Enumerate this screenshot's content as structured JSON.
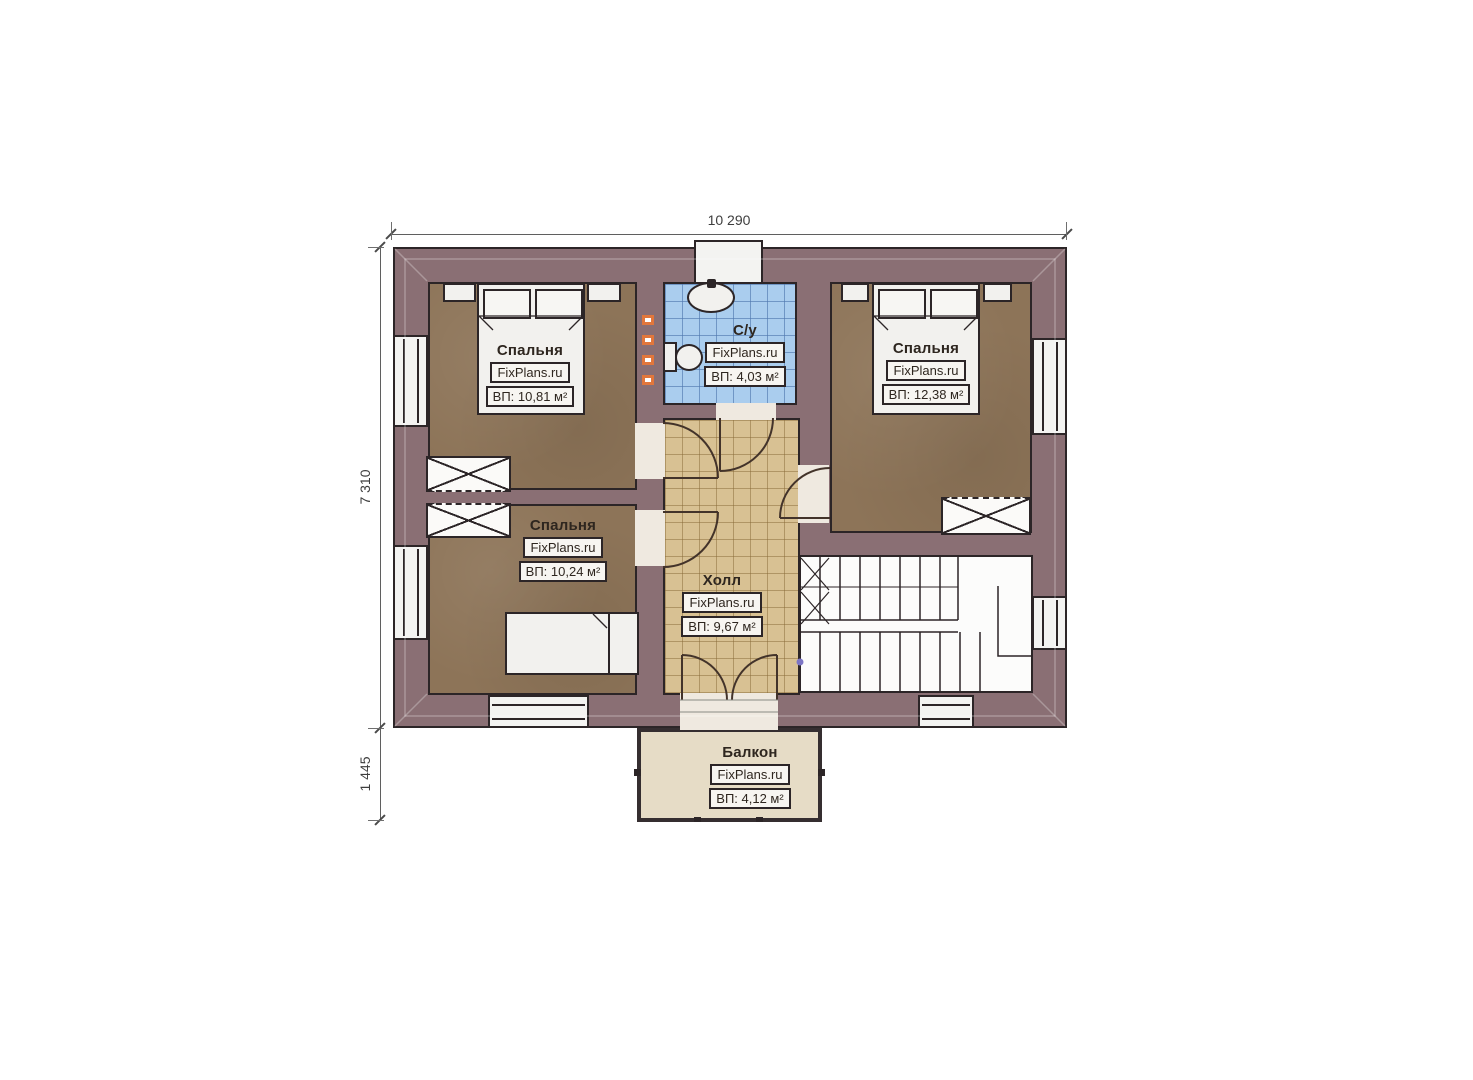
{
  "dimensions": {
    "width": "10 290",
    "height": "7 310",
    "balcony_depth": "1 445"
  },
  "watermark": "FixPlans.ru",
  "rooms": {
    "bedroom_top_left": {
      "name": "Спальня",
      "watermark": "FixPlans.ru",
      "area": "ВП: 10,81 м²"
    },
    "bathroom": {
      "name": "С/у",
      "watermark": "FixPlans.ru",
      "area": "ВП: 4,03 м²"
    },
    "bedroom_right": {
      "name": "Спальня",
      "watermark": "FixPlans.ru",
      "area": "ВП: 12,38 м²"
    },
    "bedroom_bottom_left": {
      "name": "Спальня",
      "watermark": "FixPlans.ru",
      "area": "ВП: 10,24 м²"
    },
    "hall": {
      "name": "Холл",
      "watermark": "FixPlans.ru",
      "area": "ВП: 9,67 м²"
    },
    "balcony": {
      "name": "Балкон",
      "watermark": "FixPlans.ru",
      "area": "ВП: 4,12 м²"
    }
  },
  "colors": {
    "wall": "#8a6f74",
    "bedroom_floor": "#8d7458",
    "bathroom_tile": "#aacdee",
    "hall_tile": "#d8c193",
    "balcony_floor": "#e6dcc6",
    "outline": "#2c2527",
    "towel_radiator": "#e2773c",
    "dimension_text": "#3e3e3e"
  }
}
